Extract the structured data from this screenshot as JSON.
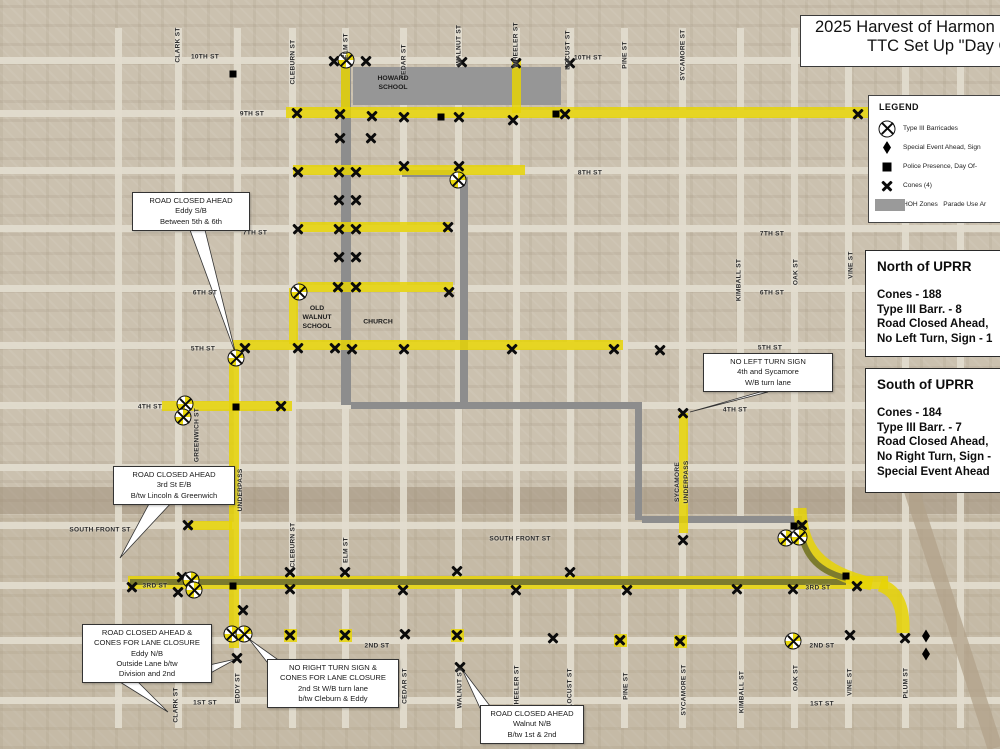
{
  "title": {
    "line1": "2025 Harvest of Harmon",
    "line2": "TTC Set Up \"Day O"
  },
  "legend": {
    "heading": "LEGEND",
    "items": [
      {
        "symbol": "barricade-icon",
        "label": "Type III Barricades"
      },
      {
        "symbol": "diamond-icon",
        "label": "Special Event Ahead, Sign"
      },
      {
        "symbol": "square-icon",
        "label": "Police Presence, Day Of-"
      },
      {
        "symbol": "cone-icon",
        "label": "Cones (4)"
      },
      {
        "symbol": "zone-swatch",
        "label": "HOH Zones   Parade Use Ar"
      }
    ]
  },
  "panels": [
    {
      "title": "North of UPRR",
      "lines": [
        "Cones - 188",
        "Type III Barr. - 8",
        "Road Closed Ahead,",
        "No Left Turn, Sign - 1"
      ]
    },
    {
      "title": "South of UPRR",
      "lines": [
        "Cones - 184",
        "Type III Barr. - 7",
        "Road Closed Ahead,",
        "No Right Turn, Sign -",
        "Special Event Ahead"
      ]
    }
  ],
  "callouts": [
    {
      "x": 132,
      "y": 192,
      "w": 112,
      "lines": [
        "ROAD CLOSED AHEAD",
        "Eddy S/B",
        "Between 5th & 6th"
      ]
    },
    {
      "x": 703,
      "y": 353,
      "w": 124,
      "lines": [
        "NO LEFT TURN SIGN",
        "4th and Sycamore",
        "W/B turn lane"
      ]
    },
    {
      "x": 113,
      "y": 466,
      "w": 116,
      "lines": [
        "ROAD CLOSED AHEAD",
        "3rd St E/B",
        "B/tw Lincoln & Greenwich"
      ]
    },
    {
      "x": 82,
      "y": 624,
      "w": 124,
      "lines": [
        "ROAD CLOSED AHEAD &",
        "CONES FOR  LANE CLOSURE",
        "Eddy N/B",
        "Outside Lane b/tw",
        "Division and 2nd"
      ]
    },
    {
      "x": 267,
      "y": 659,
      "w": 126,
      "lines": [
        "NO RIGHT TURN SIGN &",
        "CONES FOR LANE CLOSURE",
        "2nd St W/B turn lane",
        "b/tw Cleburn & Eddy"
      ]
    },
    {
      "x": 480,
      "y": 705,
      "w": 98,
      "lines": [
        "ROAD CLOSED AHEAD",
        "Walnut N/B",
        "B/tw 1st & 2nd"
      ]
    }
  ],
  "map": {
    "grid": {
      "vx": [
        118,
        178,
        237,
        292,
        345,
        403,
        458,
        516,
        570,
        624,
        682,
        740,
        794,
        848,
        905,
        960
      ],
      "hy": [
        60,
        113,
        170,
        228,
        288,
        345,
        405,
        467,
        525,
        585,
        640,
        700
      ]
    },
    "zones": [
      {
        "x": 353,
        "y": 67,
        "w": 208,
        "h": 38
      }
    ],
    "routes_gray": [
      {
        "x": 341,
        "y": 64,
        "w": 10,
        "h": 341
      },
      {
        "x": 402,
        "y": 170,
        "w": 62,
        "h": 7
      },
      {
        "x": 460,
        "y": 177,
        "w": 8,
        "h": 228
      },
      {
        "x": 351,
        "y": 402,
        "w": 290,
        "h": 7
      },
      {
        "x": 635,
        "y": 402,
        "w": 7,
        "h": 118
      },
      {
        "x": 642,
        "y": 516,
        "w": 160,
        "h": 7
      }
    ],
    "routes_olive": [
      {
        "x": 130,
        "y": 579,
        "w": 716,
        "h": 6
      }
    ],
    "routes_yellow": [
      {
        "x": 286,
        "y": 107,
        "w": 600,
        "h": 11
      },
      {
        "x": 341,
        "y": 60,
        "w": 9,
        "h": 50
      },
      {
        "x": 512,
        "y": 60,
        "w": 9,
        "h": 53
      },
      {
        "x": 293,
        "y": 165,
        "w": 232,
        "h": 10
      },
      {
        "x": 300,
        "y": 222,
        "w": 150,
        "h": 10
      },
      {
        "x": 298,
        "y": 282,
        "w": 155,
        "h": 10
      },
      {
        "x": 233,
        "y": 340,
        "w": 390,
        "h": 10
      },
      {
        "x": 162,
        "y": 401,
        "w": 130,
        "h": 10
      },
      {
        "x": 289,
        "y": 288,
        "w": 9,
        "h": 56
      },
      {
        "x": 229,
        "y": 362,
        "w": 10,
        "h": 286
      },
      {
        "x": 679,
        "y": 413,
        "w": 9,
        "h": 120
      },
      {
        "x": 128,
        "y": 576,
        "w": 760,
        "h": 13
      },
      {
        "x": 188,
        "y": 521,
        "w": 44,
        "h": 9
      },
      {
        "x": 284,
        "y": 629,
        "w": 13,
        "h": 13
      },
      {
        "x": 339,
        "y": 629,
        "w": 13,
        "h": 13
      },
      {
        "x": 451,
        "y": 629,
        "w": 13,
        "h": 13
      },
      {
        "x": 614,
        "y": 634,
        "w": 13,
        "h": 13
      },
      {
        "x": 674,
        "y": 635,
        "w": 13,
        "h": 13
      }
    ],
    "svg": {
      "yellow_paths": [
        "M 800 508 C 801 548 818 572 872 584",
        "M 880 585 C 898 591 904 608 903 633"
      ],
      "olive_paths": [
        "M 846 578 C 812 570 801 548 800 522"
      ],
      "rail_paths": [
        "M 908 480 L 995 748"
      ],
      "leader_wedges": [
        [
          [
            190,
            230
          ],
          [
            205,
            230
          ],
          [
            236,
            355
          ]
        ],
        [
          [
            150,
            502
          ],
          [
            172,
            502
          ],
          [
            120,
            558
          ]
        ],
        [
          [
            760,
            392
          ],
          [
            768,
            392
          ],
          [
            690,
            412
          ]
        ],
        [
          [
            205,
            666
          ],
          [
            205,
            676
          ],
          [
            236,
            659
          ]
        ],
        [
          [
            267,
            662
          ],
          [
            277,
            659
          ],
          [
            249,
            639
          ]
        ],
        [
          [
            480,
            708
          ],
          [
            490,
            706
          ],
          [
            462,
            669
          ]
        ],
        [
          [
            120,
            682
          ],
          [
            138,
            682
          ],
          [
            168,
            712
          ]
        ]
      ]
    },
    "street_labels_h": [
      {
        "t": "10TH ST",
        "x": 205,
        "y": 57
      },
      {
        "t": "10TH ST",
        "x": 588,
        "y": 58
      },
      {
        "t": "9TH ST",
        "x": 252,
        "y": 114
      },
      {
        "t": "9TH ST",
        "x": 933,
        "y": 115
      },
      {
        "t": "8TH ST",
        "x": 590,
        "y": 173
      },
      {
        "t": "7TH ST",
        "x": 255,
        "y": 233
      },
      {
        "t": "7TH ST",
        "x": 772,
        "y": 234
      },
      {
        "t": "6TH ST",
        "x": 205,
        "y": 293
      },
      {
        "t": "6TH ST",
        "x": 772,
        "y": 293
      },
      {
        "t": "5TH ST",
        "x": 203,
        "y": 349
      },
      {
        "t": "5TH ST",
        "x": 770,
        "y": 348
      },
      {
        "t": "4TH ST",
        "x": 150,
        "y": 407
      },
      {
        "t": "4TH ST",
        "x": 735,
        "y": 410
      },
      {
        "t": "SOUTH FRONT ST",
        "x": 100,
        "y": 530
      },
      {
        "t": "SOUTH FRONT ST",
        "x": 520,
        "y": 539
      },
      {
        "t": "3RD ST",
        "x": 155,
        "y": 586
      },
      {
        "t": "3RD ST",
        "x": 818,
        "y": 588
      },
      {
        "t": "2ND ST",
        "x": 377,
        "y": 646
      },
      {
        "t": "2ND ST",
        "x": 822,
        "y": 646
      },
      {
        "t": "1ST ST",
        "x": 205,
        "y": 703
      },
      {
        "t": "1ST ST",
        "x": 822,
        "y": 704
      }
    ],
    "street_labels_v": [
      {
        "t": "CLARK ST",
        "x": 178,
        "y": 45
      },
      {
        "t": "CLEBURN ST",
        "x": 293,
        "y": 62
      },
      {
        "t": "ELM ST",
        "x": 346,
        "y": 46
      },
      {
        "t": "CEDAR ST",
        "x": 404,
        "y": 62
      },
      {
        "t": "WALNUT ST",
        "x": 459,
        "y": 45
      },
      {
        "t": "WHEELER ST",
        "x": 516,
        "y": 45
      },
      {
        "t": "LOCUST ST",
        "x": 568,
        "y": 50
      },
      {
        "t": "PINE ST",
        "x": 625,
        "y": 55
      },
      {
        "t": "SYCAMORE ST",
        "x": 683,
        "y": 55
      },
      {
        "t": "KIMBALL ST",
        "x": 739,
        "y": 280
      },
      {
        "t": "OAK ST",
        "x": 796,
        "y": 272
      },
      {
        "t": "VINE ST",
        "x": 851,
        "y": 265
      },
      {
        "t": "GREENWICH ST",
        "x": 197,
        "y": 435
      },
      {
        "t": "EDDY ST\nUNDERPASS",
        "x": 236,
        "y": 490
      },
      {
        "t": "SYCAMORE\nUNDERPASS",
        "x": 682,
        "y": 482
      },
      {
        "t": "CLEBURN ST",
        "x": 293,
        "y": 545
      },
      {
        "t": "ELM ST",
        "x": 346,
        "y": 550
      },
      {
        "t": "CLARK ST",
        "x": 176,
        "y": 705
      },
      {
        "t": "EDDY ST",
        "x": 238,
        "y": 688
      },
      {
        "t": "CEDAR ST",
        "x": 405,
        "y": 686
      },
      {
        "t": "WALNUT ST",
        "x": 460,
        "y": 688
      },
      {
        "t": "WHEELER ST",
        "x": 517,
        "y": 688
      },
      {
        "t": "LOCUST ST",
        "x": 570,
        "y": 688
      },
      {
        "t": "PINE ST",
        "x": 626,
        "y": 686
      },
      {
        "t": "SYCAMORE ST",
        "x": 684,
        "y": 690
      },
      {
        "t": "KIMBALL ST",
        "x": 742,
        "y": 692
      },
      {
        "t": "OAK ST",
        "x": 796,
        "y": 678
      },
      {
        "t": "VINE ST",
        "x": 850,
        "y": 682
      },
      {
        "t": "PLUM ST",
        "x": 906,
        "y": 683
      }
    ],
    "place_labels": [
      {
        "t": "HOWARD\nSCHOOL",
        "x": 393,
        "y": 83
      },
      {
        "t": "OLD\nWALNUT\nSCHOOL",
        "x": 317,
        "y": 318
      },
      {
        "t": "CHURCH",
        "x": 378,
        "y": 322
      }
    ],
    "symbols": {
      "cones": [
        [
          334,
          61
        ],
        [
          366,
          61
        ],
        [
          462,
          62
        ],
        [
          516,
          63
        ],
        [
          570,
          63
        ],
        [
          297,
          113
        ],
        [
          340,
          114
        ],
        [
          372,
          116
        ],
        [
          404,
          117
        ],
        [
          459,
          117
        ],
        [
          513,
          120
        ],
        [
          565,
          114
        ],
        [
          858,
          114
        ],
        [
          340,
          138
        ],
        [
          371,
          138
        ],
        [
          298,
          172
        ],
        [
          339,
          172
        ],
        [
          356,
          172
        ],
        [
          404,
          166
        ],
        [
          459,
          166
        ],
        [
          339,
          200
        ],
        [
          356,
          200
        ],
        [
          298,
          229
        ],
        [
          339,
          229
        ],
        [
          356,
          229
        ],
        [
          448,
          227
        ],
        [
          339,
          257
        ],
        [
          356,
          257
        ],
        [
          338,
          287
        ],
        [
          356,
          287
        ],
        [
          449,
          292
        ],
        [
          245,
          348
        ],
        [
          298,
          348
        ],
        [
          335,
          348
        ],
        [
          352,
          349
        ],
        [
          404,
          349
        ],
        [
          512,
          349
        ],
        [
          614,
          349
        ],
        [
          660,
          350
        ],
        [
          281,
          406
        ],
        [
          683,
          413
        ],
        [
          188,
          525
        ],
        [
          683,
          540
        ],
        [
          132,
          587
        ],
        [
          182,
          577
        ],
        [
          178,
          592
        ],
        [
          290,
          572
        ],
        [
          290,
          589
        ],
        [
          345,
          572
        ],
        [
          403,
          590
        ],
        [
          457,
          571
        ],
        [
          516,
          590
        ],
        [
          570,
          572
        ],
        [
          627,
          590
        ],
        [
          737,
          589
        ],
        [
          793,
          589
        ],
        [
          857,
          586
        ],
        [
          802,
          525
        ],
        [
          243,
          610
        ],
        [
          237,
          658
        ],
        [
          460,
          667
        ],
        [
          290,
          635
        ],
        [
          345,
          635
        ],
        [
          405,
          634
        ],
        [
          457,
          635
        ],
        [
          553,
          638
        ],
        [
          620,
          640
        ],
        [
          680,
          641
        ],
        [
          850,
          635
        ],
        [
          905,
          638
        ]
      ],
      "barricades": [
        [
          346,
          60
        ],
        [
          458,
          180
        ],
        [
          299,
          292
        ],
        [
          236,
          358
        ],
        [
          185,
          404
        ],
        [
          183,
          417
        ],
        [
          191,
          580
        ],
        [
          194,
          590
        ],
        [
          232,
          634
        ],
        [
          244,
          634
        ],
        [
          786,
          538
        ],
        [
          799,
          537
        ],
        [
          793,
          641
        ]
      ],
      "squares": [
        [
          233,
          74
        ],
        [
          441,
          117
        ],
        [
          556,
          114
        ],
        [
          236,
          407
        ],
        [
          233,
          586
        ],
        [
          794,
          526
        ],
        [
          846,
          576
        ]
      ],
      "diamonds": [
        [
          926,
          636
        ],
        [
          926,
          654
        ]
      ]
    },
    "colors": {
      "route_yellow": "#e6d405",
      "route_olive": "#7c7b2e",
      "route_gray": "#8d8d8d",
      "zone_gray": "#969696"
    }
  }
}
